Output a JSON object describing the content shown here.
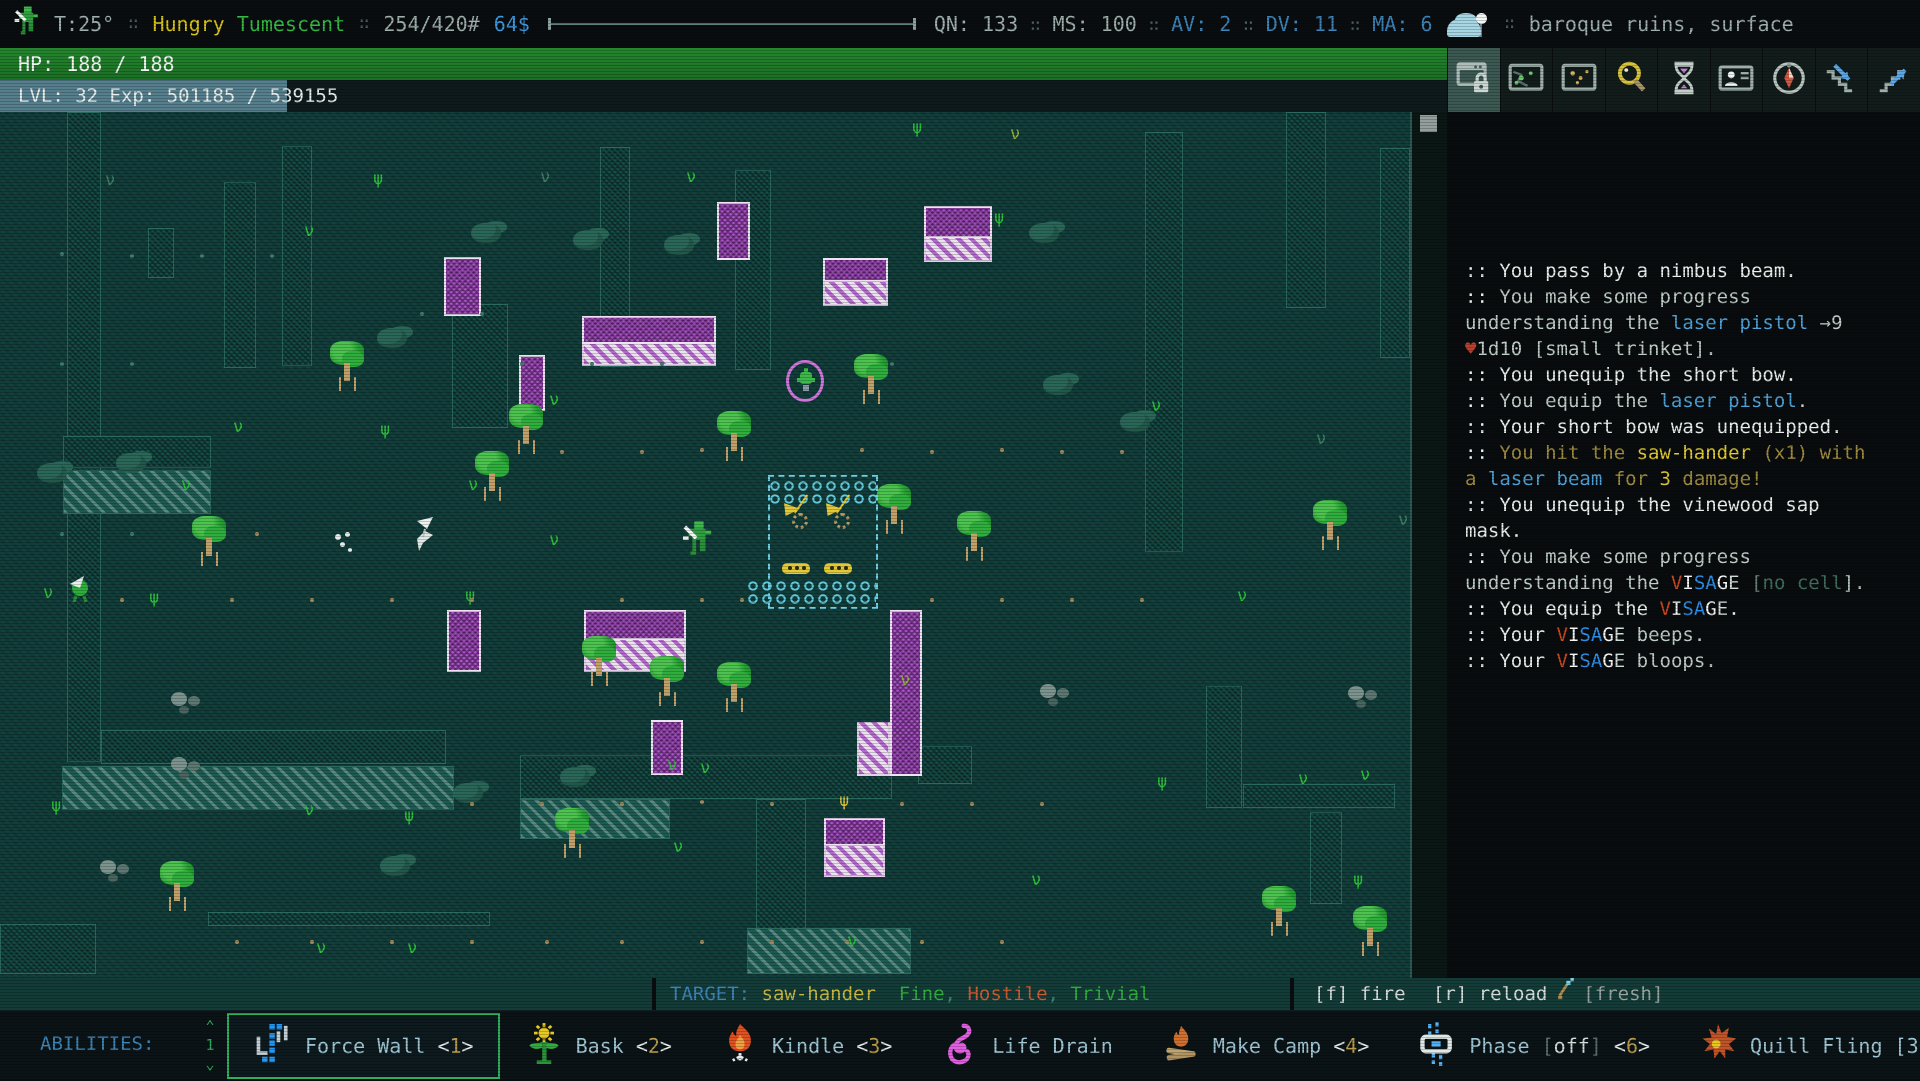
{
  "status_bar": {
    "temperature": "T:25°",
    "separator": "∷",
    "effects": [
      {
        "text": "Hungry",
        "color": "#d9c31a"
      },
      {
        "text": "Tumescent",
        "color": "#35b944"
      }
    ],
    "weight": "254/420#",
    "money": "64$",
    "stats": [
      {
        "label": "QN:",
        "value": "133",
        "color": "#9fb0ad"
      },
      {
        "label": "MS:",
        "value": "100",
        "color": "#9fb0ad"
      },
      {
        "label": "AV:",
        "value": "2",
        "color": "#3d85b8"
      },
      {
        "label": "DV:",
        "value": "11",
        "color": "#3d85b8"
      },
      {
        "label": "MA:",
        "value": "6",
        "color": "#3d85b8"
      }
    ],
    "weather_icon": "cloud-night",
    "location": "baroque ruins, surface",
    "location_color": "#7e99a8"
  },
  "hp_bar": {
    "text": "HP: 188 / 188",
    "color": "#1e7d28"
  },
  "xp_bar": {
    "text": "LVL: 32 Exp: 501185 / 539155",
    "fill_px": 287,
    "fill_color": "#567f8e"
  },
  "toolbar": {
    "buttons": [
      {
        "icon": "window-lock-icon",
        "active": true
      },
      {
        "icon": "map-local-icon",
        "active": false
      },
      {
        "icon": "map-world-icon",
        "active": false
      },
      {
        "icon": "magnifier-icon",
        "active": false
      },
      {
        "icon": "hourglass-icon",
        "active": false
      },
      {
        "icon": "character-card-icon",
        "active": false
      },
      {
        "icon": "compass-icon",
        "active": false
      },
      {
        "icon": "stairs-down-icon",
        "active": false
      },
      {
        "icon": "stairs-up-icon",
        "active": false
      }
    ]
  },
  "log": {
    "lines": [
      [
        {
          "t": ":: You pass by a nimbus beam.",
          "c": "#e9efec"
        }
      ],
      [
        {
          "t": ":: ",
          "c": "#e9efec"
        },
        {
          "t": "You make some progress",
          "c": "#c0cdc7"
        }
      ],
      [
        {
          "t": "understanding the ",
          "c": "#c0cdc7"
        },
        {
          "t": "laser pistol",
          "c": "#4da2d8"
        },
        {
          "t": " →9",
          "c": "#c0cdc7"
        }
      ],
      [
        {
          "t": "♥",
          "c": "#b5402e"
        },
        {
          "t": "1d10 [small trinket].",
          "c": "#c0cdc7"
        }
      ],
      [
        {
          "t": ":: You unequip the short bow.",
          "c": "#e9efec"
        }
      ],
      [
        {
          "t": ":: ",
          "c": "#e9efec"
        },
        {
          "t": "You equip the ",
          "c": "#c0cdc7"
        },
        {
          "t": "laser pistol",
          "c": "#4da2d8"
        },
        {
          "t": ".",
          "c": "#c0cdc7"
        }
      ],
      [
        {
          "t": ":: Your short bow was unequipped.",
          "c": "#e9efec"
        }
      ],
      [
        {
          "t": ":: ",
          "c": "#e9efec"
        },
        {
          "t": "You hit the ",
          "c": "#a08c3e"
        },
        {
          "t": "saw-hander",
          "c": "#e3cb32"
        },
        {
          "t": " (x1) with",
          "c": "#a08c3e"
        }
      ],
      [
        {
          "t": "a ",
          "c": "#a08c3e"
        },
        {
          "t": "laser beam",
          "c": "#4da2d8"
        },
        {
          "t": " for ",
          "c": "#a08c3e"
        },
        {
          "t": "3",
          "c": "#d9c23a"
        },
        {
          "t": " damage!",
          "c": "#a08c3e"
        }
      ],
      [
        {
          "t": ":: You unequip the vinewood sap",
          "c": "#e9efec"
        }
      ],
      [
        {
          "t": "mask.",
          "c": "#e9efec"
        }
      ],
      [
        {
          "t": ":: ",
          "c": "#e9efec"
        },
        {
          "t": "You make some progress",
          "c": "#c0cdc7"
        }
      ],
      [
        {
          "t": "understanding the ",
          "c": "#c0cdc7"
        },
        {
          "t": "V",
          "c": "#cc4a1e"
        },
        {
          "t": "I",
          "c": "#f2f5f3"
        },
        {
          "t": "S",
          "c": "#2d8fe8"
        },
        {
          "t": "A",
          "c": "#2d8fe8"
        },
        {
          "t": "G",
          "c": "#f2f5f3"
        },
        {
          "t": "E",
          "c": "#cfdbd6"
        },
        {
          "t": " [",
          "c": "#6c837c"
        },
        {
          "t": "no cell",
          "c": "#3f6e60"
        },
        {
          "t": "].",
          "c": "#b9c6c1"
        }
      ],
      [
        {
          "t": ":: You equip the ",
          "c": "#e9efec"
        },
        {
          "t": "V",
          "c": "#cc4a1e"
        },
        {
          "t": "I",
          "c": "#f2f5f3"
        },
        {
          "t": "S",
          "c": "#2d8fe8"
        },
        {
          "t": "A",
          "c": "#2d8fe8"
        },
        {
          "t": "G",
          "c": "#f2f5f3"
        },
        {
          "t": "E",
          "c": "#cfdbd6"
        },
        {
          "t": ".",
          "c": "#e9efec"
        }
      ],
      [
        {
          "t": ":: Your ",
          "c": "#e9efec"
        },
        {
          "t": "V",
          "c": "#cc4a1e"
        },
        {
          "t": "I",
          "c": "#f2f5f3"
        },
        {
          "t": "S",
          "c": "#2d8fe8"
        },
        {
          "t": "A",
          "c": "#2d8fe8"
        },
        {
          "t": "G",
          "c": "#f2f5f3"
        },
        {
          "t": "E",
          "c": "#cfdbd6"
        },
        {
          "t": " beeps.",
          "c": "#c0cdc7"
        }
      ],
      [
        {
          "t": ":: Your ",
          "c": "#e9efec"
        },
        {
          "t": "V",
          "c": "#cc4a1e"
        },
        {
          "t": "I",
          "c": "#f2f5f3"
        },
        {
          "t": "S",
          "c": "#2d8fe8"
        },
        {
          "t": "A",
          "c": "#2d8fe8"
        },
        {
          "t": "G",
          "c": "#f2f5f3"
        },
        {
          "t": "E",
          "c": "#cfdbd6"
        },
        {
          "t": " bloops.",
          "c": "#c0cdc7"
        }
      ]
    ]
  },
  "bottom": {
    "active_effects_label": "ACTIVE EFFECTS:",
    "target_segments": [
      {
        "t": "TARGET: ",
        "c": "#3d85b8"
      },
      {
        "t": "saw-hander",
        "c": "#c9b83f"
      },
      {
        "t": "  Fine",
        "c": "#2fae3e"
      },
      {
        "t": ", ",
        "c": "#3a8a7a"
      },
      {
        "t": "Hostile",
        "c": "#cc5c33"
      },
      {
        "t": ", ",
        "c": "#3a8a7a"
      },
      {
        "t": "Trivial",
        "c": "#2fae3e"
      }
    ],
    "fire_label": "[f] fire",
    "reload_label": "[r] reload",
    "fresh_label": "[fresh]"
  },
  "abilities": {
    "label": "ABILITIES:",
    "page": "1",
    "pager_up": "⌃",
    "pager_down": "⌄",
    "items": [
      {
        "name": "Force Wall",
        "hotkey": "1",
        "icon": "force-wall-icon",
        "selected": true,
        "suffix": []
      },
      {
        "name": "Bask",
        "hotkey": "2",
        "icon": "bask-icon",
        "selected": false,
        "suffix": []
      },
      {
        "name": "Kindle",
        "hotkey": "3",
        "icon": "kindle-icon",
        "selected": false,
        "suffix": []
      },
      {
        "name": "Life Drain",
        "hotkey": "",
        "icon": "life-drain-icon",
        "selected": false,
        "suffix": []
      },
      {
        "name": "Make Camp",
        "hotkey": "4",
        "icon": "make-camp-icon",
        "selected": false,
        "suffix": []
      },
      {
        "name": "Phase",
        "hotkey": "6",
        "icon": "phase-icon",
        "selected": false,
        "suffix": [
          {
            "t": "[",
            "c": "#5c6e6a"
          },
          {
            "t": "off",
            "c": "#d3dcd9"
          },
          {
            "t": "]",
            "c": "#5c6e6a"
          }
        ]
      },
      {
        "name": "Quill Fling",
        "hotkey": "7",
        "icon": "quill-fling-icon",
        "selected": false,
        "suffix": [
          {
            "t": "[300 quills left]",
            "c": "#9fc6d4"
          }
        ]
      }
    ]
  },
  "map": {
    "ghost_walls": [
      [
        67,
        0,
        34,
        650
      ],
      [
        101,
        618,
        345,
        34
      ],
      [
        224,
        70,
        32,
        186
      ],
      [
        282,
        34,
        30,
        220
      ],
      [
        148,
        116,
        26,
        50
      ],
      [
        63,
        324,
        148,
        32
      ],
      [
        452,
        192,
        56,
        124
      ],
      [
        600,
        35,
        30,
        220
      ],
      [
        735,
        58,
        36,
        200
      ],
      [
        1145,
        20,
        38,
        420
      ],
      [
        1286,
        0,
        40,
        196
      ],
      [
        1380,
        36,
        30,
        210
      ],
      [
        520,
        643,
        372,
        44
      ],
      [
        756,
        687,
        50,
        132
      ],
      [
        918,
        634,
        54,
        38
      ],
      [
        1206,
        574,
        36,
        122
      ],
      [
        1243,
        672,
        152,
        24
      ],
      [
        0,
        812,
        96,
        50
      ],
      [
        208,
        800,
        282,
        14
      ],
      [
        1310,
        700,
        32,
        92
      ]
    ],
    "hatch_rows": [
      [
        62,
        654,
        392,
        44
      ],
      [
        63,
        358,
        148,
        44
      ],
      [
        747,
        816,
        164,
        46
      ],
      [
        520,
        687,
        150,
        40
      ]
    ],
    "purple_walls": [
      [
        444,
        145,
        37,
        59
      ],
      [
        519,
        243,
        26,
        56
      ],
      [
        582,
        204,
        134,
        28
      ],
      [
        717,
        90,
        33,
        58
      ],
      [
        823,
        146,
        65,
        24
      ],
      [
        924,
        94,
        68,
        32
      ],
      [
        447,
        498,
        34,
        62
      ],
      [
        584,
        498,
        102,
        30
      ],
      [
        890,
        498,
        32,
        166
      ],
      [
        651,
        608,
        32,
        55
      ],
      [
        824,
        706,
        61,
        28
      ]
    ],
    "purple_hatch": [
      [
        582,
        232,
        134,
        22
      ],
      [
        823,
        170,
        65,
        24
      ],
      [
        924,
        126,
        68,
        24
      ],
      [
        584,
        528,
        102,
        32
      ],
      [
        857,
        610,
        33,
        54
      ],
      [
        824,
        734,
        61,
        31
      ]
    ],
    "trees": [
      [
        348,
        255
      ],
      [
        527,
        318
      ],
      [
        735,
        325
      ],
      [
        872,
        268
      ],
      [
        895,
        398
      ],
      [
        975,
        425
      ],
      [
        1331,
        414
      ],
      [
        210,
        430
      ],
      [
        600,
        550
      ],
      [
        668,
        570
      ],
      [
        735,
        576
      ],
      [
        178,
        775
      ],
      [
        1280,
        800
      ],
      [
        1371,
        820
      ],
      [
        573,
        722
      ],
      [
        493,
        365
      ]
    ],
    "bushes": [
      [
        471,
        111
      ],
      [
        573,
        118
      ],
      [
        664,
        123
      ],
      [
        1029,
        111
      ],
      [
        1043,
        263
      ],
      [
        377,
        216
      ],
      [
        453,
        671
      ],
      [
        380,
        744
      ],
      [
        116,
        341
      ],
      [
        37,
        351
      ],
      [
        560,
        655
      ],
      [
        1120,
        300
      ]
    ],
    "rocks": [
      [
        171,
        580
      ],
      [
        171,
        645
      ],
      [
        1040,
        572
      ],
      [
        1348,
        574
      ],
      [
        100,
        748
      ]
    ],
    "grass": [
      [
        373,
        59,
        "ψ",
        "#2ec23c"
      ],
      [
        304,
        111,
        "ν",
        "#2ec23c"
      ],
      [
        233,
        307,
        "ν",
        "#2ec23c"
      ],
      [
        380,
        310,
        "ψ",
        "#2ec23c"
      ],
      [
        181,
        365,
        "ν",
        "#2ec23c"
      ],
      [
        149,
        478,
        "ψ",
        "#2ec23c"
      ],
      [
        43,
        473,
        "ν",
        "#2ec23c"
      ],
      [
        549,
        280,
        "ν",
        "#2ec23c"
      ],
      [
        468,
        365,
        "ν",
        "#2ec23c"
      ],
      [
        549,
        420,
        "ν",
        "#2ec23c"
      ],
      [
        465,
        476,
        "ψ",
        "#2ec23c"
      ],
      [
        51,
        686,
        "ψ",
        "#2ec23c"
      ],
      [
        304,
        690,
        "ν",
        "#2ec23c"
      ],
      [
        404,
        696,
        "ψ",
        "#2ec23c"
      ],
      [
        686,
        57,
        "ν",
        "#2ec23c"
      ],
      [
        912,
        8,
        "ψ",
        "#2ec23c"
      ],
      [
        1010,
        14,
        "ν",
        "#93b33c"
      ],
      [
        994,
        98,
        "ψ",
        "#2ec23c"
      ],
      [
        1151,
        286,
        "ν",
        "#2ec23c"
      ],
      [
        1316,
        319,
        "ν",
        "#3f7f68"
      ],
      [
        1237,
        476,
        "ν",
        "#2ec23c"
      ],
      [
        1298,
        659,
        "ν",
        "#2ec23c"
      ],
      [
        1157,
        662,
        "ψ",
        "#2ec23c"
      ],
      [
        673,
        727,
        "ν",
        "#2ec23c"
      ],
      [
        1031,
        760,
        "ν",
        "#2ec23c"
      ],
      [
        1353,
        760,
        "ψ",
        "#2ec23c"
      ],
      [
        847,
        821,
        "ν",
        "#2ec23c"
      ],
      [
        316,
        828,
        "ν",
        "#2ec23c"
      ],
      [
        407,
        828,
        "ν",
        "#2ec23c"
      ],
      [
        1398,
        400,
        "ν",
        "#3f7f68"
      ],
      [
        540,
        57,
        "ν",
        "#3f7f68"
      ],
      [
        105,
        60,
        "ν",
        "#3f7f68"
      ],
      [
        1360,
        655,
        "ν",
        "#2ec23c"
      ],
      [
        900,
        560,
        "ν",
        "#93b33c"
      ],
      [
        667,
        645,
        "ν",
        "#2ec23c"
      ],
      [
        700,
        648,
        "ν",
        "#2ec23c"
      ],
      [
        839,
        681,
        "ψ",
        "#d9c23a"
      ]
    ],
    "dots": [
      [
        560,
        338,
        "#a08a5e"
      ],
      [
        640,
        338,
        "#a08a5e"
      ],
      [
        700,
        336,
        "#a08a5e"
      ],
      [
        860,
        336,
        "#a08a5e"
      ],
      [
        930,
        338,
        "#a08a5e"
      ],
      [
        1000,
        336,
        "#a08a5e"
      ],
      [
        1060,
        338,
        "#a08a5e"
      ],
      [
        1120,
        338,
        "#a08a5e"
      ],
      [
        255,
        420,
        "#a08a5e"
      ],
      [
        120,
        486,
        "#a08a5e"
      ],
      [
        230,
        486,
        "#a08a5e"
      ],
      [
        310,
        486,
        "#a08a5e"
      ],
      [
        390,
        486,
        "#a08a5e"
      ],
      [
        470,
        486,
        "#a08a5e"
      ],
      [
        620,
        486,
        "#a08a5e"
      ],
      [
        700,
        486,
        "#a08a5e"
      ],
      [
        740,
        486,
        "#a08a5e"
      ],
      [
        930,
        486,
        "#a08a5e"
      ],
      [
        1000,
        486,
        "#a08a5e"
      ],
      [
        1070,
        486,
        "#a08a5e"
      ],
      [
        1140,
        486,
        "#a08a5e"
      ],
      [
        470,
        690,
        "#a08a5e"
      ],
      [
        540,
        690,
        "#a08a5e"
      ],
      [
        620,
        690,
        "#a08a5e"
      ],
      [
        700,
        688,
        "#a08a5e"
      ],
      [
        770,
        690,
        "#a08a5e"
      ],
      [
        900,
        690,
        "#a08a5e"
      ],
      [
        970,
        690,
        "#a08a5e"
      ],
      [
        1040,
        690,
        "#a08a5e"
      ],
      [
        235,
        828,
        "#a08a5e"
      ],
      [
        310,
        828,
        "#a08a5e"
      ],
      [
        390,
        828,
        "#a08a5e"
      ],
      [
        470,
        828,
        "#a08a5e"
      ],
      [
        545,
        828,
        "#a08a5e"
      ],
      [
        620,
        828,
        "#a08a5e"
      ],
      [
        700,
        828,
        "#a08a5e"
      ],
      [
        770,
        828,
        "#a08a5e"
      ],
      [
        845,
        828,
        "#a08a5e"
      ],
      [
        920,
        828,
        "#a08a5e"
      ],
      [
        1000,
        828,
        "#a08a5e"
      ],
      [
        60,
        140,
        "#3f7a6e"
      ],
      [
        130,
        142,
        "#3f7a6e"
      ],
      [
        200,
        142,
        "#3f7a6e"
      ],
      [
        270,
        142,
        "#3f7a6e"
      ],
      [
        520,
        250,
        "#3f7a6e"
      ],
      [
        590,
        250,
        "#3f7a6e"
      ],
      [
        660,
        250,
        "#3f7a6e"
      ],
      [
        420,
        200,
        "#3f7a6e"
      ],
      [
        480,
        200,
        "#3f7a6e"
      ],
      [
        60,
        250,
        "#3f7a6e"
      ],
      [
        130,
        250,
        "#3f7a6e"
      ],
      [
        60,
        420,
        "#3f7a6e"
      ],
      [
        130,
        420,
        "#3f7a6e"
      ],
      [
        890,
        250,
        "#3f7a6e"
      ]
    ],
    "pool": {
      "rect": [
        768,
        363,
        110,
        134
      ],
      "water_bands": [
        [
          -2,
          2,
          108,
          26
        ],
        [
          -24,
          102,
          130,
          28
        ]
      ],
      "machines": [
        [
          14,
          48
        ],
        [
          56,
          48
        ]
      ],
      "boats": [
        [
          12,
          86
        ],
        [
          54,
          86
        ]
      ]
    },
    "creatures": [
      {
        "type": "player",
        "x": 683,
        "y": 406
      },
      {
        "type": "sawhander",
        "x": 413,
        "y": 402
      },
      {
        "type": "specks",
        "x": 335,
        "y": 420
      },
      {
        "type": "ring",
        "x": 786,
        "y": 248
      },
      {
        "type": "greenwhite",
        "x": 66,
        "y": 460
      }
    ]
  }
}
